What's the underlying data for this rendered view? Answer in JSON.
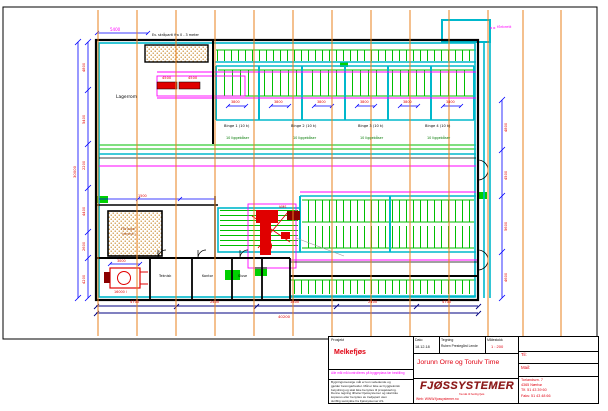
{
  "title_block": {
    "prosjekt_label": "Prosjekt",
    "prosjekt_value": "Melkefjøs",
    "dato_label": "Dato",
    "dato_value": "18.12.18",
    "tegning_label": "Tegning",
    "tegning_value": "Ruben Prestegård Lende",
    "malestokk_label": "Målestokk",
    "malestokk_value": "1 : 200",
    "customer": "Jorunn Orre og Torulv Time",
    "notice": "Alle mål må kontrolleres på byggeplass før bestilling",
    "disclaimer_lines": [
      "Bygningsmessige mål er kun veiledende og",
      "gjelder betongarbeider. Mål er ikke av byggteknisk",
      "betydning og skal ikke benyttes til prosjektering.",
      "Denne tegning tilhører Fjøssystemer og skal ikke",
      "kopieres eller benyttes av tredjepart uten",
      "skriftlig samtykke fra Fjøssystemer AS."
    ],
    "logo_text": "FJØSSYSTEMER",
    "logo_tagline": "fra idé til ferdig fjøs",
    "web": "Web: WWW.fjossystemer.no",
    "til_label": "Til:",
    "mail_label": "Mail:",
    "address_lines": [
      "Torlandsvn. 7",
      "4365 Nærbø",
      "Tlf. 51 43 39 60",
      "Faks: 51 43 48 66"
    ]
  },
  "drawing": {
    "colors": {
      "grid_orange": "#e8821e",
      "wall_cyan": "#00b8cc",
      "pen_green": "#00bf00",
      "dim_blue": "#0000ff",
      "dim_navy": "#000080",
      "accent_red": "#e00000",
      "magenta": "#ff00ff",
      "hatch_dot": "#c8882a",
      "logo_red": "#8c1a1a"
    },
    "labels": [
      {
        "t": "5400",
        "x": 110,
        "y": 27.5,
        "c": "#ff00ff",
        "s": 4,
        "n": "dim-label"
      },
      {
        "t": "Ev. skråparti fra 0 - 3 meter",
        "x": 152,
        "y": 33.5,
        "c": "#000000",
        "s": 3.4,
        "n": "note-label"
      },
      {
        "t": "fôrbrett",
        "x": 497,
        "y": 25,
        "c": "#ff00ff",
        "s": 3.8,
        "n": "note-label"
      },
      {
        "t": "4500",
        "x": 162,
        "y": 77,
        "c": "#e00000",
        "s": 3.6,
        "n": "dim-label"
      },
      {
        "t": "4500",
        "x": 188,
        "y": 77,
        "c": "#e00000",
        "s": 3.6,
        "n": "dim-label"
      },
      {
        "t": "Lagerrom",
        "x": 116,
        "y": 96,
        "c": "#000000",
        "s": 4.4,
        "n": "room-label"
      },
      {
        "t": "3800",
        "x": 231,
        "y": 101,
        "c": "#e00000",
        "s": 3.4,
        "n": "dim-label"
      },
      {
        "t": "3800",
        "x": 274,
        "y": 101,
        "c": "#e00000",
        "s": 3.4,
        "n": "dim-label"
      },
      {
        "t": "3800",
        "x": 317,
        "y": 101,
        "c": "#e00000",
        "s": 3.4,
        "n": "dim-label"
      },
      {
        "t": "3800",
        "x": 360,
        "y": 101,
        "c": "#e00000",
        "s": 3.4,
        "n": "dim-label"
      },
      {
        "t": "3800",
        "x": 403,
        "y": 101,
        "c": "#e00000",
        "s": 3.4,
        "n": "dim-label"
      },
      {
        "t": "3800",
        "x": 446,
        "y": 101,
        "c": "#e00000",
        "s": 3.4,
        "n": "dim-label"
      },
      {
        "t": "Binge 1 (10 k)",
        "x": 224,
        "y": 125,
        "c": "#000000",
        "s": 3.6,
        "n": "pen-label"
      },
      {
        "t": "Binge 2 (10 k)",
        "x": 291,
        "y": 125,
        "c": "#000000",
        "s": 3.6,
        "n": "pen-label"
      },
      {
        "t": "Binge 3 (10 k)",
        "x": 358,
        "y": 125,
        "c": "#000000",
        "s": 3.6,
        "n": "pen-label"
      },
      {
        "t": "Binge 4 (10 k)",
        "x": 425,
        "y": 125,
        "c": "#000000",
        "s": 3.6,
        "n": "pen-label"
      },
      {
        "t": "10 liggebåser",
        "x": 226,
        "y": 136.5,
        "c": "#007800",
        "s": 3.4,
        "n": "pen-label"
      },
      {
        "t": "10 liggebåser",
        "x": 293,
        "y": 136.5,
        "c": "#007800",
        "s": 3.4,
        "n": "pen-label"
      },
      {
        "t": "10 liggebåser",
        "x": 360,
        "y": 136.5,
        "c": "#007800",
        "s": 3.4,
        "n": "pen-label"
      },
      {
        "t": "10 liggebåser",
        "x": 427,
        "y": 136.5,
        "c": "#007800",
        "s": 3.4,
        "n": "pen-label"
      },
      {
        "t": "1500",
        "x": 138,
        "y": 194.5,
        "c": "#e00000",
        "s": 3.4,
        "n": "dim-label"
      },
      {
        "t": "Fôrlager",
        "x": 121,
        "y": 228,
        "c": "#a04000",
        "s": 3.6,
        "n": "room-label"
      },
      {
        "t": "(eksist.)",
        "x": 122,
        "y": 233,
        "c": "#a04000",
        "s": 3.4,
        "n": "room-label"
      },
      {
        "t": "VMS",
        "x": 279,
        "y": 206,
        "c": "#e00000",
        "s": 3.4,
        "n": "equipment-label"
      },
      {
        "t": "3000",
        "x": 117,
        "y": 259.5,
        "c": "#e00000",
        "s": 3.4,
        "n": "dim-label"
      },
      {
        "t": "16000 l",
        "x": 114,
        "y": 291,
        "c": "#e00000",
        "s": 3.4,
        "n": "equipment-label"
      },
      {
        "t": "Teknisk",
        "x": 159,
        "y": 275,
        "c": "#000000",
        "s": 3.4,
        "n": "room-label"
      },
      {
        "t": "Kontor",
        "x": 202,
        "y": 275,
        "c": "#000000",
        "s": 3.4,
        "n": "room-label"
      },
      {
        "t": "Sluse",
        "x": 238,
        "y": 275,
        "c": "#000000",
        "s": 3.4,
        "n": "room-label"
      },
      {
        "t": "4800",
        "x": 83,
        "y": 72,
        "c": "#e00000",
        "s": 3.6,
        "rot": -90,
        "n": "dim-label"
      },
      {
        "t": "5400",
        "x": 83,
        "y": 124,
        "c": "#e00000",
        "s": 3.6,
        "rot": -90,
        "n": "dim-label"
      },
      {
        "t": "2200",
        "x": 83,
        "y": 170,
        "c": "#e00000",
        "s": 3.6,
        "rot": -90,
        "n": "dim-label"
      },
      {
        "t": "4400",
        "x": 83,
        "y": 216,
        "c": "#e00000",
        "s": 3.6,
        "rot": -90,
        "n": "dim-label"
      },
      {
        "t": "2600",
        "x": 83,
        "y": 251,
        "c": "#e00000",
        "s": 3.6,
        "rot": -90,
        "n": "dim-label"
      },
      {
        "t": "4200",
        "x": 83,
        "y": 284,
        "c": "#e00000",
        "s": 3.6,
        "rot": -90,
        "n": "dim-label"
      },
      {
        "t": "30000",
        "x": 73,
        "y": 178,
        "c": "#e00000",
        "s": 3.8,
        "rot": -90,
        "n": "dim-label"
      },
      {
        "t": "4800",
        "x": 505,
        "y": 132,
        "c": "#e00000",
        "s": 3.6,
        "rot": -90,
        "n": "dim-label"
      },
      {
        "t": "4500",
        "x": 505,
        "y": 180,
        "c": "#e00000",
        "s": 3.6,
        "rot": -90,
        "n": "dim-label"
      },
      {
        "t": "5600",
        "x": 505,
        "y": 231,
        "c": "#e00000",
        "s": 3.6,
        "rot": -90,
        "n": "dim-label"
      },
      {
        "t": "4600",
        "x": 505,
        "y": 282,
        "c": "#e00000",
        "s": 3.6,
        "rot": -90,
        "n": "dim-label"
      },
      {
        "t": "4700",
        "x": 130,
        "y": 300.5,
        "c": "#e00000",
        "s": 3.6,
        "n": "dim-label"
      },
      {
        "t": "2400",
        "x": 210,
        "y": 300.5,
        "c": "#e00000",
        "s": 3.6,
        "n": "dim-label"
      },
      {
        "t": "1800",
        "x": 290,
        "y": 300.5,
        "c": "#e00000",
        "s": 3.6,
        "n": "dim-label"
      },
      {
        "t": "2400",
        "x": 368,
        "y": 300.5,
        "c": "#e00000",
        "s": 3.6,
        "n": "dim-label"
      },
      {
        "t": "4700",
        "x": 442,
        "y": 300.5,
        "c": "#e00000",
        "s": 3.6,
        "n": "dim-label"
      },
      {
        "t": "40200",
        "x": 278,
        "y": 314.5,
        "c": "#e00000",
        "s": 3.8,
        "n": "dim-label"
      }
    ]
  }
}
